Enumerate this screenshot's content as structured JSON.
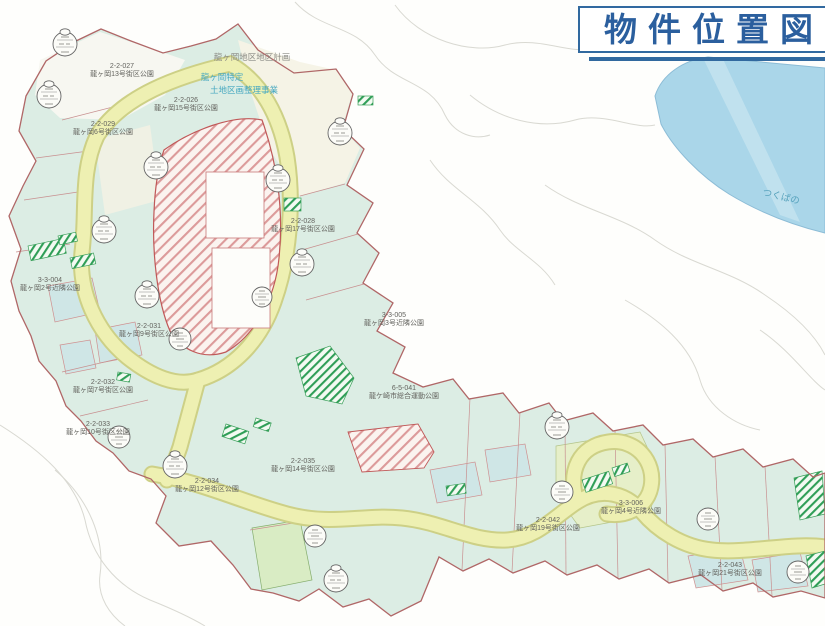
{
  "title": {
    "text": "物件位置図"
  },
  "header_notes": {
    "district_plan": "龍ヶ岡地区地区計画",
    "project_line1": "龍ヶ岡特定",
    "project_line2": "土地区画整理事業"
  },
  "adjacent_area": {
    "label": "つくばの"
  },
  "map": {
    "labels": [
      {
        "code": "2-2-027",
        "name": "龍ヶ岡13号街区公園"
      },
      {
        "code": "2-2-026",
        "name": "龍ヶ岡15号街区公園"
      },
      {
        "code": "2-2-029",
        "name": "龍ヶ岡6号街区公園"
      },
      {
        "code": "2-2-028",
        "name": "龍ヶ岡17号街区公園"
      },
      {
        "code": "3-3-004",
        "name": "龍ヶ岡2号近隣公園"
      },
      {
        "code": "2-2-031",
        "name": "龍ヶ岡9号街区公園"
      },
      {
        "code": "3-3-005",
        "name": "龍ヶ岡3号近隣公園"
      },
      {
        "code": "6-5-041",
        "name": "龍ケ崎市総合運動公園"
      },
      {
        "code": "2-2-032",
        "name": "龍ヶ岡7号街区公園"
      },
      {
        "code": "2-2-033",
        "name": "龍ヶ岡10号街区公園"
      },
      {
        "code": "2-2-034",
        "name": "龍ヶ岡12号街区公園"
      },
      {
        "code": "2-2-035",
        "name": "龍ヶ岡14号街区公園"
      },
      {
        "code": "2-2-042",
        "name": "龍ヶ岡19号街区公園"
      },
      {
        "code": "3-3-006",
        "name": "龍ヶ岡4号近隣公園"
      },
      {
        "code": "2-2-043",
        "name": "龍ヶ岡21号街区公園"
      }
    ],
    "colors": {
      "title_blue": "#2b5f9e",
      "frame_blue": "#31699f",
      "adjacent_water": "#aad6e9",
      "district_fill": "#dcede4",
      "road_yellow": "#eef0b2",
      "boundary_red": "#b06767",
      "park_hatch_green": "#2f9e57",
      "plan_hatch_pink": "#dc9a9a",
      "label_gray": "#63635e",
      "note_teal": "#46a8c0"
    }
  }
}
